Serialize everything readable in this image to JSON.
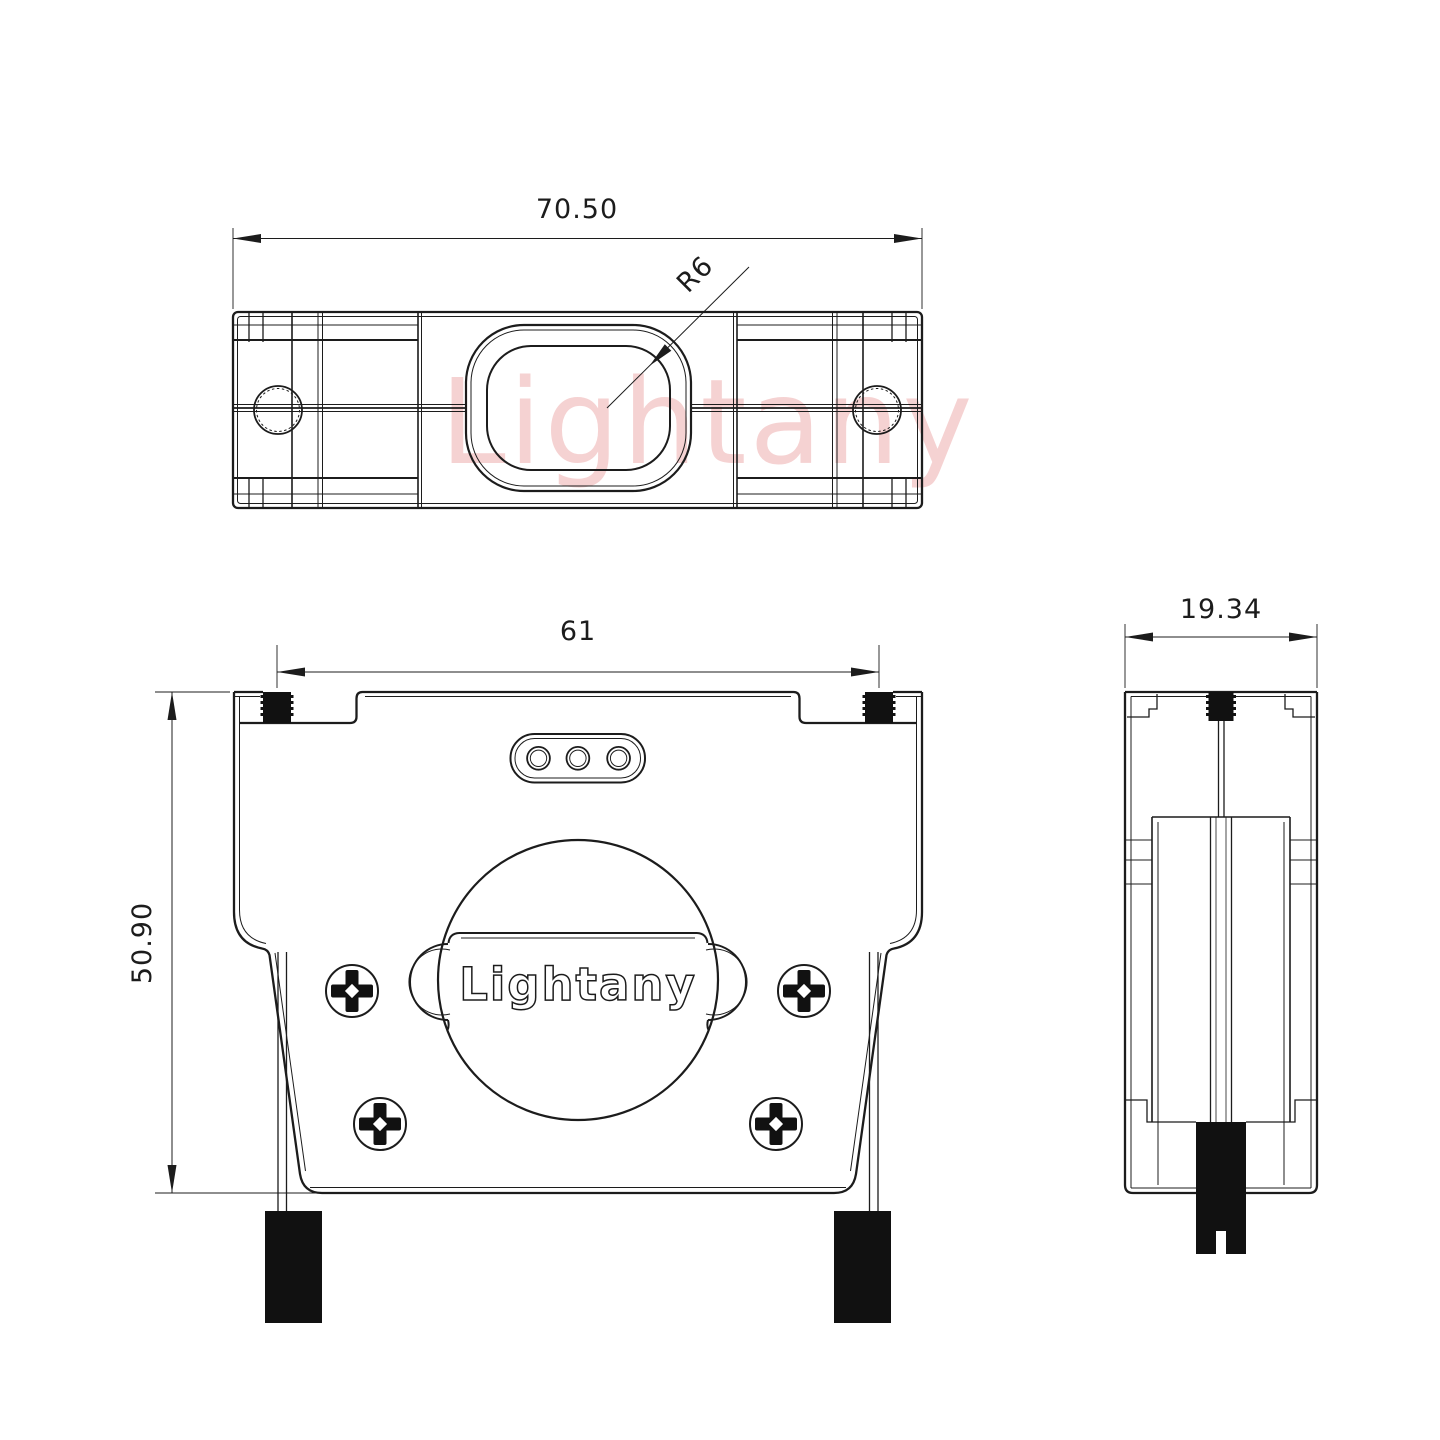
{
  "drawing": {
    "title": "connector-backshell-three-view-drawing",
    "background_color": "#ffffff",
    "line_color": "#1c1c1c",
    "boot_color": "#111111",
    "watermark": {
      "text": "Lightany",
      "color": "#f0b5b5"
    },
    "views": {
      "top_view": {
        "width_dim": "70.50",
        "radius_callout": "R6"
      },
      "front_view": {
        "width_dim": "61",
        "height_dim": "50.90",
        "logo_text": "Lightany"
      },
      "side_view": {
        "width_dim": "19.34"
      }
    }
  }
}
